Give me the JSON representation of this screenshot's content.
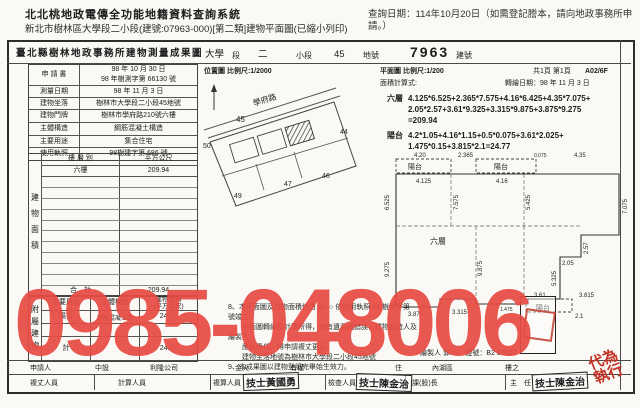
{
  "header": {
    "system_title": "北北桃地政電傳全功能地籍資料查詢系統",
    "query_date": "查詢日期：114年10月20日（如需登記謄本，請向地政事務所申請。）",
    "subtitle": "新北市樹林區大學段二小段(建號:07963-000)[第二類]建物平面圖(已縮小列印)"
  },
  "watermark": {
    "text": "0985-048006",
    "color": "#e84c44"
  },
  "doc": {
    "title": "臺北縣樹林地政事務所建物測量成果圖",
    "section": {
      "v1": "大學",
      "l1": "段",
      "v2": "二",
      "l2": "小段",
      "v3": "45",
      "l3": "地號",
      "v4": "7963",
      "l4": "建號"
    },
    "info_rows": [
      {
        "label": "申 請 書",
        "value": "98 年 10 月 30 日",
        "value2": "98 年樹測字第 66130 號"
      },
      {
        "label": "測量日期",
        "value": "98 年 11 月 3 日"
      },
      {
        "label": "建物坐落",
        "value": "樹林市大學段二小段45地號"
      },
      {
        "label": "建物門牌",
        "value": "樹林市學府路210號六樓"
      },
      {
        "label": "主體構造",
        "value": "鋼筋混凝土構造"
      },
      {
        "label": "主要用途",
        "value": "集合住宅"
      },
      {
        "label": "使用執照",
        "value": "98樹建字第 686 號"
      }
    ],
    "area_table": {
      "side": "建物面積",
      "h1": "樓 層 別",
      "h2": "平方公尺",
      "floor": "六樓",
      "area": "209.94",
      "total_label": "合　計",
      "total": "209.94"
    },
    "annex_table": {
      "side": "附屬建物",
      "h1": "主要用途",
      "h2": "主體構造",
      "h3a": "建物面積",
      "h3b": "(平方公尺)",
      "use": "陽台",
      "structure": "鋼筋混凝土造",
      "area": "24.77",
      "total_label": "計",
      "total": "24.77"
    },
    "location": {
      "title": "位置圖 比例尺:1/2000",
      "road": "學府路",
      "p45": "45",
      "p44": "44",
      "p46": "46",
      "p47": "47",
      "p49": "49",
      "p50": "50"
    },
    "plan": {
      "title": "平面圖 比例尺:1/200",
      "pages": "共1頁 第1頁",
      "code": "A02/6F",
      "calc_label": "面積計算式:",
      "redraw_date": "轉繪日期：98 年 11 月 3 日",
      "floor_name": "六層",
      "calc1a": "4.125*6.525+2.365*7.575+4.16*6.425+4.35*7.075+",
      "calc1b": "2.05*2.57+3.61*9.325+3.315*9.875+3.875*9.275",
      "calc1c": "=209.94",
      "balcony_name": "陽台",
      "calc2a": "4.2*1.05+4.16*1.15+0.5*0.075+3.61*2.025+",
      "calc2b": "1.475*0.15+3.815*2.1=24.77",
      "room_label": "六層",
      "balcony_label": "陽台",
      "dims": {
        "d420": "4.20",
        "d2365": "2.365",
        "d0075": "0.075",
        "d435": "4.35",
        "d4125": "4.125",
        "d416": "4.16",
        "d6525": "6.525",
        "d7575": "7.575",
        "d5425": "5.425",
        "d7075": "7.075",
        "d257": "2.57",
        "d205": "2.05",
        "d5325": "5.325",
        "d9875": "9.875",
        "d9275": "9.275",
        "d361": "3.61",
        "d3815": "3.815",
        "d21": "2.1",
        "d1475": "1.475",
        "d3315": "3.315",
        "d3875": "3.875"
      }
    },
    "notes": [
      "8、本平面圖及建物面積係由 郭○○ 依使用執照 98 樹使字第　　號竣工",
      "　　平面圖轉繪及計算所得，如有遺漏或錯誤，建物起造人及繪製人",
      "　　應負責任，得申請複丈更正。",
      "　　建物坐落地號為樹林市大學段二小段45地號",
      "9、本成果圖以建物登記完畢始生效力。"
    ],
    "drafter_line": "繪製人 郭○○　證號：B2 30002",
    "applicant": {
      "label": "申請人",
      "f1": "中設",
      "f2": "利隆公司",
      "f3": "金火",
      "f4": "有權",
      "f5": "住",
      "f6": "內湖區",
      "f7": "樓之"
    },
    "personnel": {
      "l1": "複丈人員",
      "l2": "計算人員",
      "l3": "複算人員",
      "s3": "技士黃國勇",
      "l4": "檢查人員",
      "s4": "技士陳金治",
      "l5": "課(股)長",
      "l6": "主　任",
      "s6": "技士陳金治",
      "red": "代為執行"
    }
  }
}
